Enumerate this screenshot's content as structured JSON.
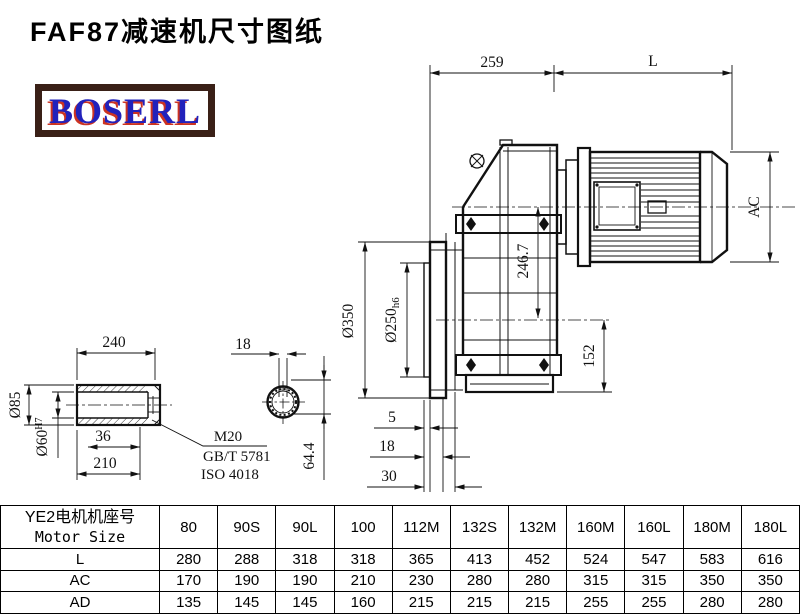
{
  "title": "FAF87减速机尺寸图纸",
  "logo": {
    "text": "BOSERL",
    "text_color": "#2222bb",
    "border_color": "#3a2017",
    "shadow_color": "#cc3322"
  },
  "drawing": {
    "main_view": {
      "dim_259": "259",
      "dim_L": "L",
      "dim_AC": "AC",
      "dim_246_7": "246.7",
      "dim_dia350": "Ø350",
      "dim_dia250": "Ø250",
      "dim_dia250_tol": "h6",
      "dim_152": "152",
      "dim_5": "5",
      "dim_18": "18",
      "dim_30": "30"
    },
    "shaft_view": {
      "dim_240": "240",
      "dim_dia85": "Ø85",
      "dim_dia60": "Ø60",
      "dim_dia60_tol": "H7",
      "dim_36": "36",
      "dim_210": "210",
      "note_thread": "M20",
      "note_std1": "GB/T 5781",
      "note_std2": "ISO 4018"
    },
    "end_view": {
      "dim_18": "18",
      "dim_64_4": "64.4"
    }
  },
  "table": {
    "header": {
      "line1": "YE2电机机座号",
      "line2": "Motor Size"
    },
    "columns": [
      "80",
      "90S",
      "90L",
      "100",
      "112M",
      "132S",
      "132M",
      "160M",
      "160L",
      "180M",
      "180L"
    ],
    "rows": [
      {
        "label": "L",
        "values": [
          "280",
          "288",
          "318",
          "318",
          "365",
          "413",
          "452",
          "524",
          "547",
          "583",
          "616"
        ]
      },
      {
        "label": "AC",
        "values": [
          "170",
          "190",
          "190",
          "210",
          "230",
          "280",
          "280",
          "315",
          "315",
          "350",
          "350"
        ]
      },
      {
        "label": "AD",
        "values": [
          "135",
          "145",
          "145",
          "160",
          "215",
          "215",
          "215",
          "255",
          "255",
          "280",
          "280"
        ]
      }
    ]
  }
}
